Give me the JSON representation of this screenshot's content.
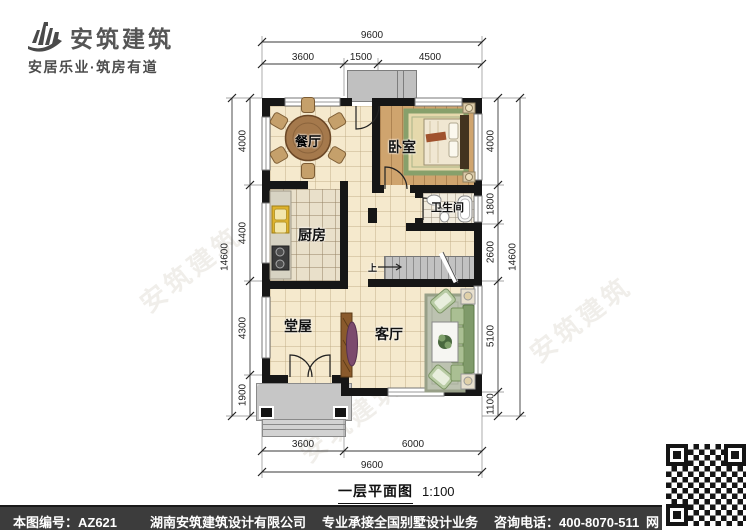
{
  "logo": {
    "name": "安筑建筑",
    "tagline": "安居乐业·筑房有道"
  },
  "watermark": "安筑建筑",
  "plan": {
    "title": "一层平面图",
    "scale": "1:100",
    "rooms": {
      "dining": "餐厅",
      "bedroom": "卧室",
      "kitchen": "厨房",
      "bathroom": "卫生间",
      "hall": "堂屋",
      "living": "客厅"
    },
    "stair_up": "上",
    "dims": {
      "top_total": "9600",
      "top_segs": [
        "3600",
        "1500",
        "4500"
      ],
      "left_total": "14600",
      "left_segs": [
        "4000",
        "4400",
        "4300",
        "1900"
      ],
      "right_total": "14600",
      "right_segs": [
        "4000",
        "1800",
        "2600",
        "5100",
        "1100"
      ],
      "bottom_segs": [
        "3600",
        "6000"
      ],
      "bottom_total": "9600"
    }
  },
  "footer": {
    "plan_code": "本图编号：AZ621",
    "company": "湖南安筑建筑设计有限公司",
    "service": "专业承接全国别墅设计业务",
    "phone": "咨询电话：400-8070-511",
    "web": "网"
  }
}
